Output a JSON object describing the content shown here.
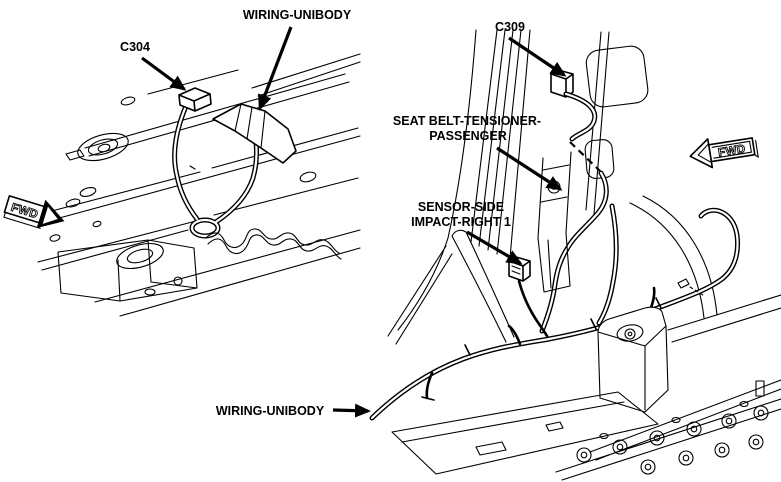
{
  "diagram": {
    "kind": "automotive-service-wiring-illustration",
    "background_color": "#ffffff",
    "line_color": "#000000",
    "text_color": "#000000"
  },
  "views": [
    {
      "name": "floor-pan-underbody-view",
      "fwd_label": "FWD",
      "callouts": [
        {
          "label": "C304",
          "points_to": "connector-c304"
        },
        {
          "label": "WIRING-UNIBODY",
          "points_to": "unibody-harness-taped-branch"
        }
      ]
    },
    {
      "name": "b-pillar-floor-view",
      "fwd_label": "FWD",
      "callouts": [
        {
          "label": "C309",
          "points_to": "connector-c309"
        },
        {
          "label_line1": "SEAT BELT-TENSIONER-",
          "label_line2": "PASSENGER",
          "points_to": "seat-belt-tensioner-passenger"
        },
        {
          "label_line1": "SENSOR-SIDE",
          "label_line2": "IMPACT-RIGHT 1",
          "points_to": "side-impact-sensor-right-1"
        },
        {
          "label": "WIRING-UNIBODY",
          "points_to": "unibody-harness-floor-run"
        }
      ]
    }
  ]
}
